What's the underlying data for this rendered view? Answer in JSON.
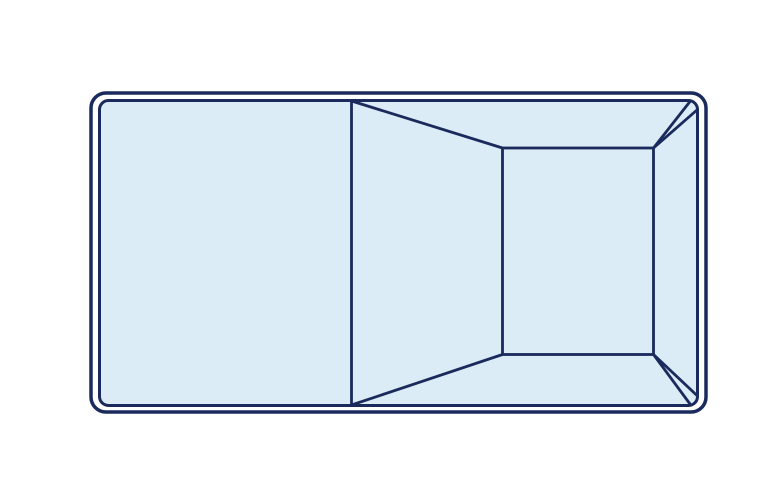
{
  "diagram": {
    "name": "rectangular-pool-top-view",
    "canvas": {
      "width": 783,
      "height": 497,
      "background": "#ffffff"
    },
    "colors": {
      "outline": "#1a2a5c",
      "water": "#dcecf6",
      "coping_gap": "#ffffff"
    },
    "stroke_widths": {
      "outer_border": 3.5,
      "inner_border": 3,
      "detail": 2.8
    },
    "outer_shell": {
      "x": 91,
      "y": 93,
      "width": 615,
      "height": 319,
      "radius": 15
    },
    "inner_shell": {
      "x": 99.5,
      "y": 100.5,
      "width": 598,
      "height": 305,
      "radius": 9
    },
    "deep_end_floor": {
      "x": 502.5,
      "y": 148,
      "width": 151,
      "height": 206.5
    },
    "detail_lines": [
      {
        "name": "shallow-end-break-line",
        "x1": 351.5,
        "y1": 100.5,
        "x2": 351.5,
        "y2": 405.5
      },
      {
        "name": "slope-top-edge",
        "x1": 351.5,
        "y1": 101,
        "x2": 502.5,
        "y2": 148
      },
      {
        "name": "slope-bottom-edge",
        "x1": 351.5,
        "y1": 405,
        "x2": 502.5,
        "y2": 354.5
      },
      {
        "name": "deep-corner-top-edge-a",
        "x1": 653.5,
        "y1": 148,
        "x2": 690,
        "y2": 101.5
      },
      {
        "name": "deep-corner-top-edge-b",
        "x1": 653.5,
        "y1": 148,
        "x2": 697.5,
        "y2": 109.5
      },
      {
        "name": "deep-corner-bottom-edge-a",
        "x1": 653.5,
        "y1": 354.5,
        "x2": 690,
        "y2": 404
      },
      {
        "name": "deep-corner-bottom-edge-b",
        "x1": 653.5,
        "y1": 354.5,
        "x2": 697.5,
        "y2": 396
      }
    ]
  }
}
